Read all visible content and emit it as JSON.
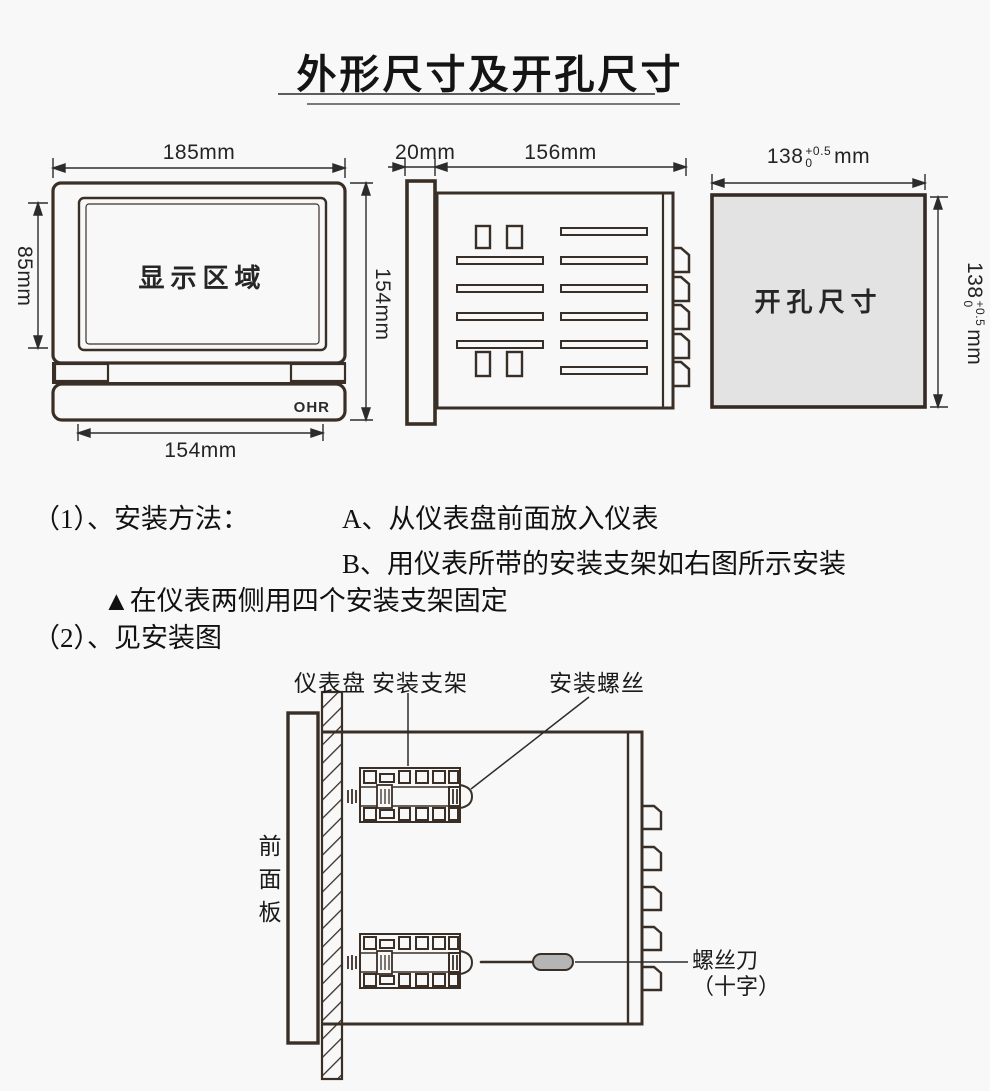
{
  "title": "外形尺寸及开孔尺寸",
  "front_view": {
    "display_area": "显示区域",
    "brand": "OHR",
    "width": "185mm",
    "display_height": "85mm",
    "height": "154mm",
    "body_width": "154mm"
  },
  "side_view": {
    "bezel_depth": "20mm",
    "body_depth": "156mm"
  },
  "cutout": {
    "label": "开孔尺寸",
    "value": "138",
    "tol_upper": "+0.5",
    "tol_lower": "0",
    "unit": "mm"
  },
  "instructions": {
    "item1": "（1）、安装方法：",
    "step_a": "A、从仪表盘前面放入仪表",
    "step_b": "B、用仪表所带的安装支架如右图所示安装",
    "note": "▲在仪表两侧用四个安装支架固定",
    "item2": "（2）、见安装图"
  },
  "install": {
    "panel": "仪表盘",
    "bracket": "安装支架",
    "screw": "安装螺丝",
    "front_panel": "前面板",
    "screwdriver": "螺丝刀",
    "screwdriver_type": "（十字）"
  }
}
